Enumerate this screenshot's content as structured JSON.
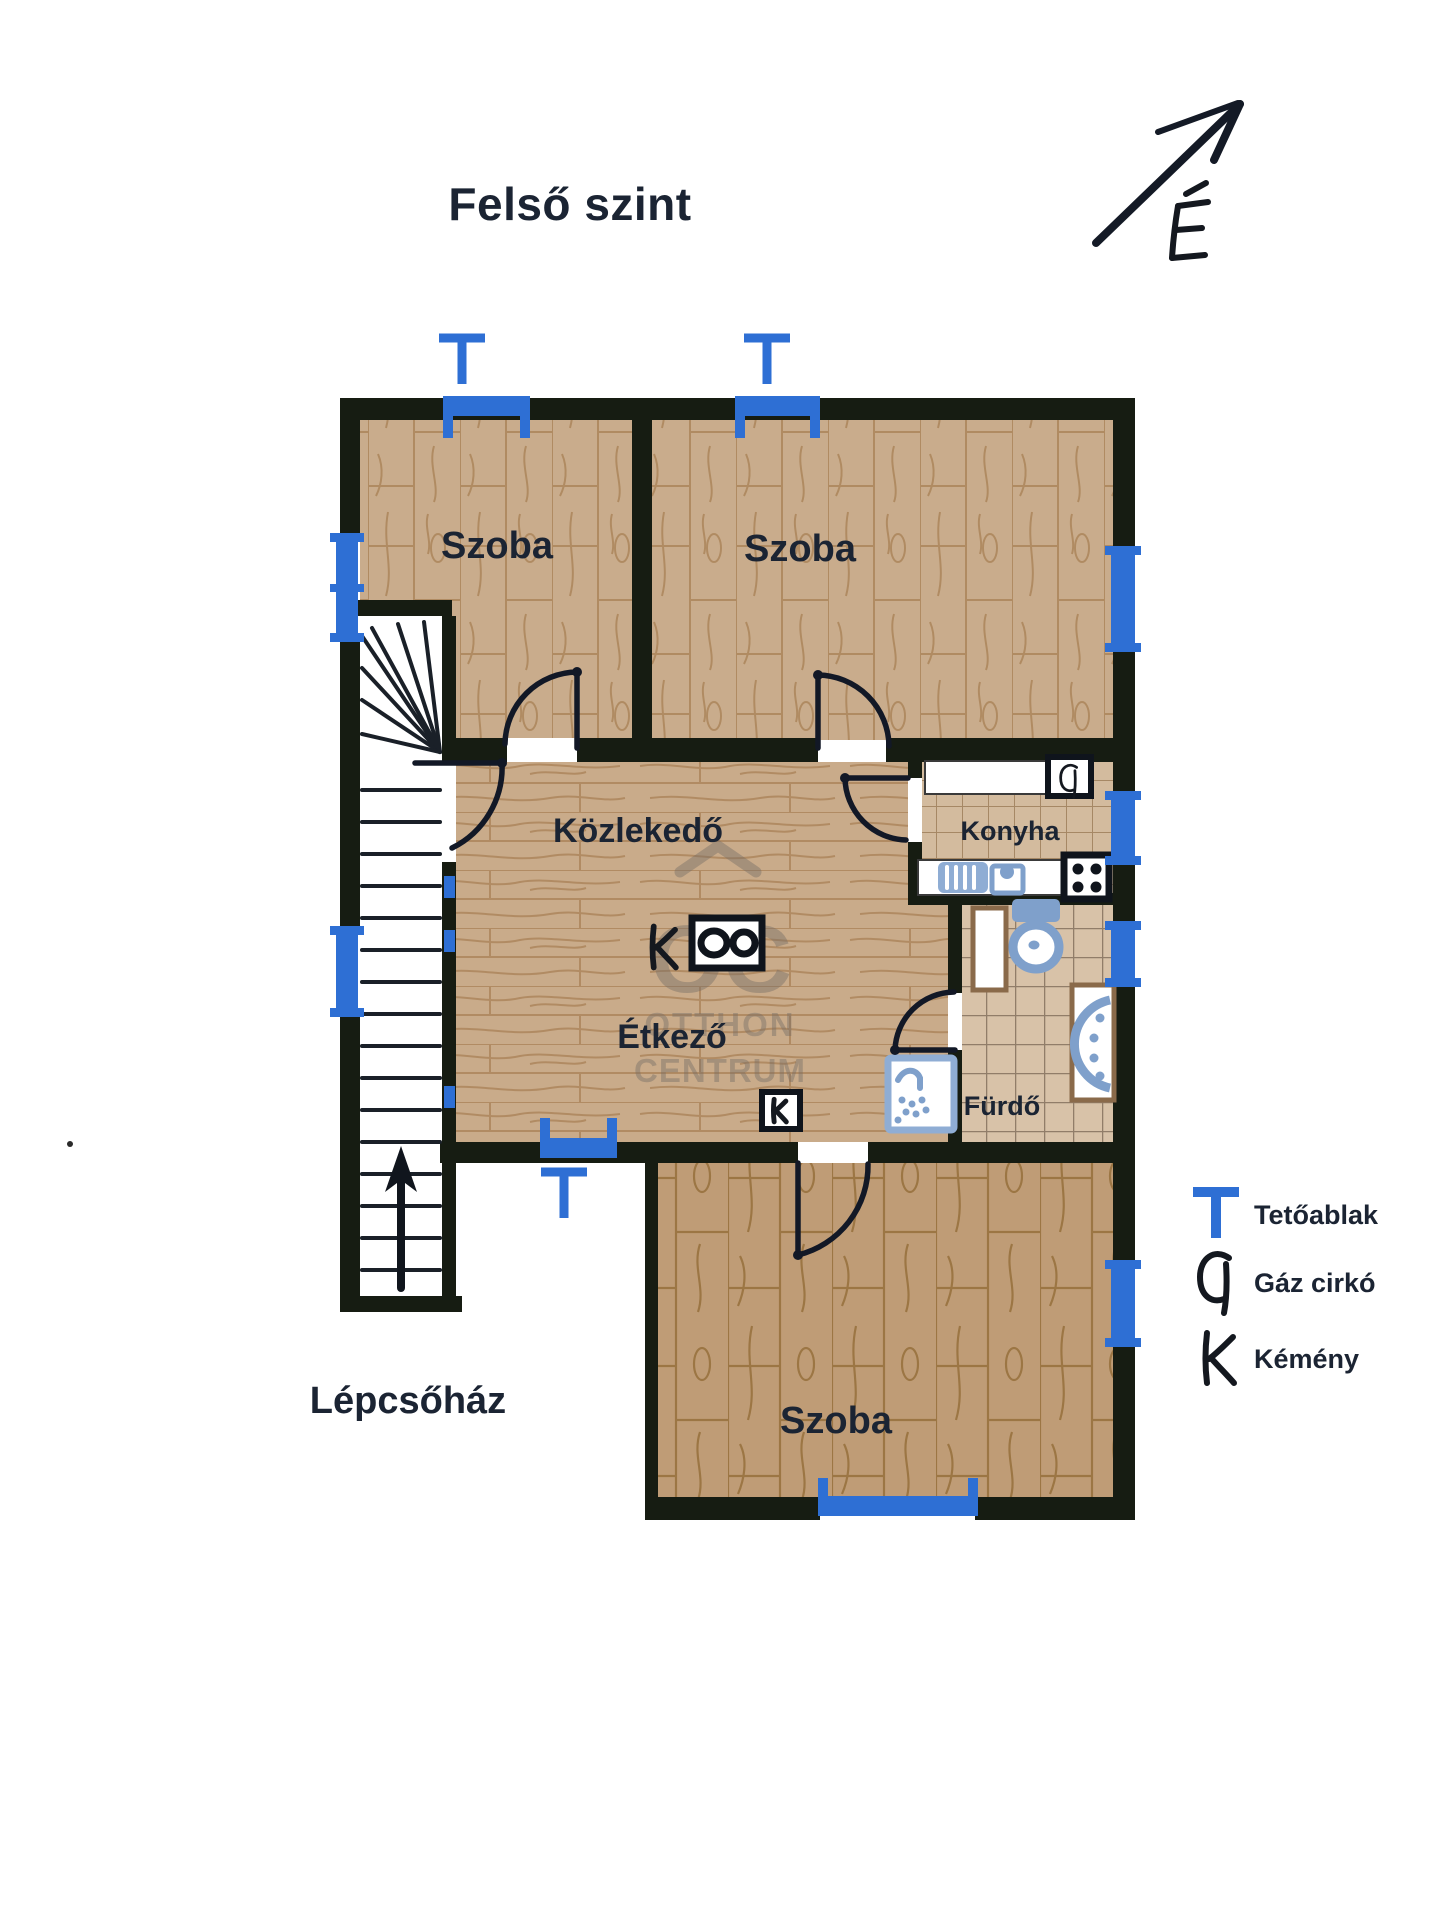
{
  "title": "Felső szint",
  "north": {
    "label": "É"
  },
  "rooms": {
    "szoba1": {
      "label": "Szoba"
    },
    "szoba2": {
      "label": "Szoba"
    },
    "hallway": {
      "label": "Közlekedő"
    },
    "kitchen": {
      "label": "Konyha"
    },
    "dining": {
      "label": "Étkező"
    },
    "bathroom": {
      "label": "Fürdő"
    },
    "szoba3": {
      "label": "Szoba"
    },
    "staircase": {
      "label": "Lépcsőház"
    }
  },
  "plan_symbols": {
    "chimney_letter": "K",
    "boiler_letter": "G"
  },
  "legend": {
    "items": [
      {
        "id": "roof-window",
        "symbol": "T",
        "label": "Tetőablak"
      },
      {
        "id": "gas-boiler",
        "symbol": "G",
        "label": "Gáz cirkó"
      },
      {
        "id": "chimney",
        "symbol": "K",
        "label": "Kémény"
      }
    ]
  },
  "watermark": {
    "mark": "OC",
    "line1": "OTTHON",
    "line2": "CENTRUM"
  },
  "colors": {
    "wall": "#161c12",
    "window_blue": "#2e6fd4",
    "fixture_blue": "#7fa0cb",
    "counter_brown": "#8a6a4a",
    "label_text": "#1b2433",
    "wood_light": "#c9ac8c",
    "wood_dark": "#bf9c76",
    "tile": "#d3bb9e"
  }
}
